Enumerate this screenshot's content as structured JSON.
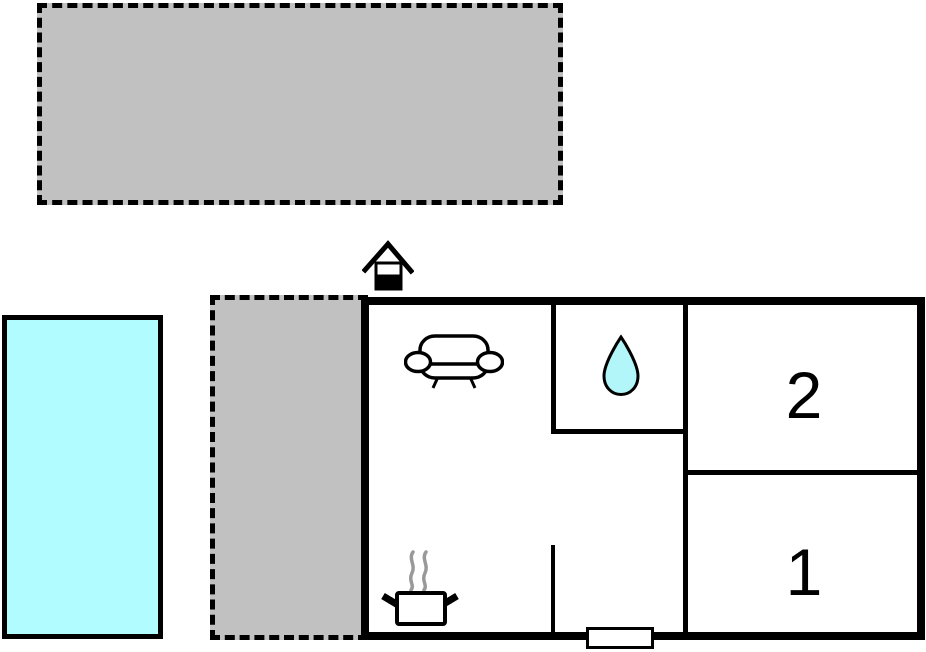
{
  "page": {
    "type": "floor-plan",
    "background": "#ffffff"
  },
  "rooms": [
    {
      "label": "2"
    },
    {
      "label": "1"
    }
  ],
  "icons": [
    {
      "name": "entrance-icon",
      "represents": "entrance door marker above building"
    },
    {
      "name": "sofa-icon",
      "represents": "sofa in living room"
    },
    {
      "name": "water-drop-icon",
      "represents": "water drop in bathroom"
    },
    {
      "name": "cooking-pot-icon",
      "represents": "steaming pot in kitchen area"
    },
    {
      "name": "door-opening-marker",
      "represents": "opening in bottom exterior wall"
    }
  ],
  "colors": {
    "walls": "#000000",
    "plot_fill": "#c1c1c1",
    "pool_fill": "#b0fcff",
    "water_drop_fill": "#b2f6f9",
    "steam": "#999999",
    "background": "#ffffff"
  }
}
